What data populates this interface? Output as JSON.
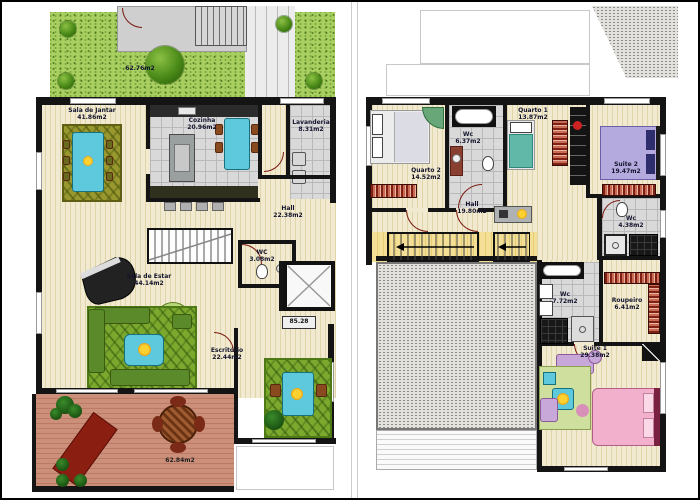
{
  "document": {
    "kind": "residential duplex floor plans",
    "unit_suffix": "m2"
  },
  "lower_floor": {
    "garden": {
      "area": "62.76m2"
    },
    "terrace": {
      "area": "62.84m2"
    },
    "elevator_mark": "85.28",
    "rooms": {
      "sala_jantar": {
        "name": "Sala de Jantar",
        "area": "41.86m2"
      },
      "cozinha": {
        "name": "Cozinha",
        "area": "20.96m2"
      },
      "lavanderia": {
        "name": "Lavanderia",
        "area": "8.31m2"
      },
      "hall": {
        "name": "Hall",
        "area": "22.38m2"
      },
      "wc": {
        "name": "WC",
        "area": "3.08m2"
      },
      "sala_estar": {
        "name": "Sala de Estar",
        "area": "44.14m2"
      },
      "escritorio": {
        "name": "Escritório",
        "area": "22.44m2"
      }
    }
  },
  "upper_floor": {
    "rooms": {
      "quarto2": {
        "name": "Quarto 2",
        "area": "14.52m2"
      },
      "wc_quartos": {
        "name": "Wc",
        "area": "6.37m2"
      },
      "quarto1": {
        "name": "Quarto 1",
        "area": "13.87m2"
      },
      "suite2": {
        "name": "Suite 2",
        "area": "19.47m2"
      },
      "wc_suite2": {
        "name": "Wc",
        "area": "4.38m2"
      },
      "hall": {
        "name": "Hall",
        "area": "19.80m2"
      },
      "wc_suite1": {
        "name": "Wc",
        "area": "7.72m2"
      },
      "roupeiro": {
        "name": "Roupeiro",
        "area": "6.41m2"
      },
      "suite1": {
        "name": "Suite 1",
        "area": "29.38m2"
      }
    }
  },
  "colors": {
    "grass": "#a8cf60",
    "floor_stripe": "#f1ead0",
    "tile": "#d9d9d9",
    "deck": "#cb8f7a",
    "wall": "#141414",
    "furniture_accent": "#5ec8dc",
    "wardrobe": "#c86a54"
  }
}
